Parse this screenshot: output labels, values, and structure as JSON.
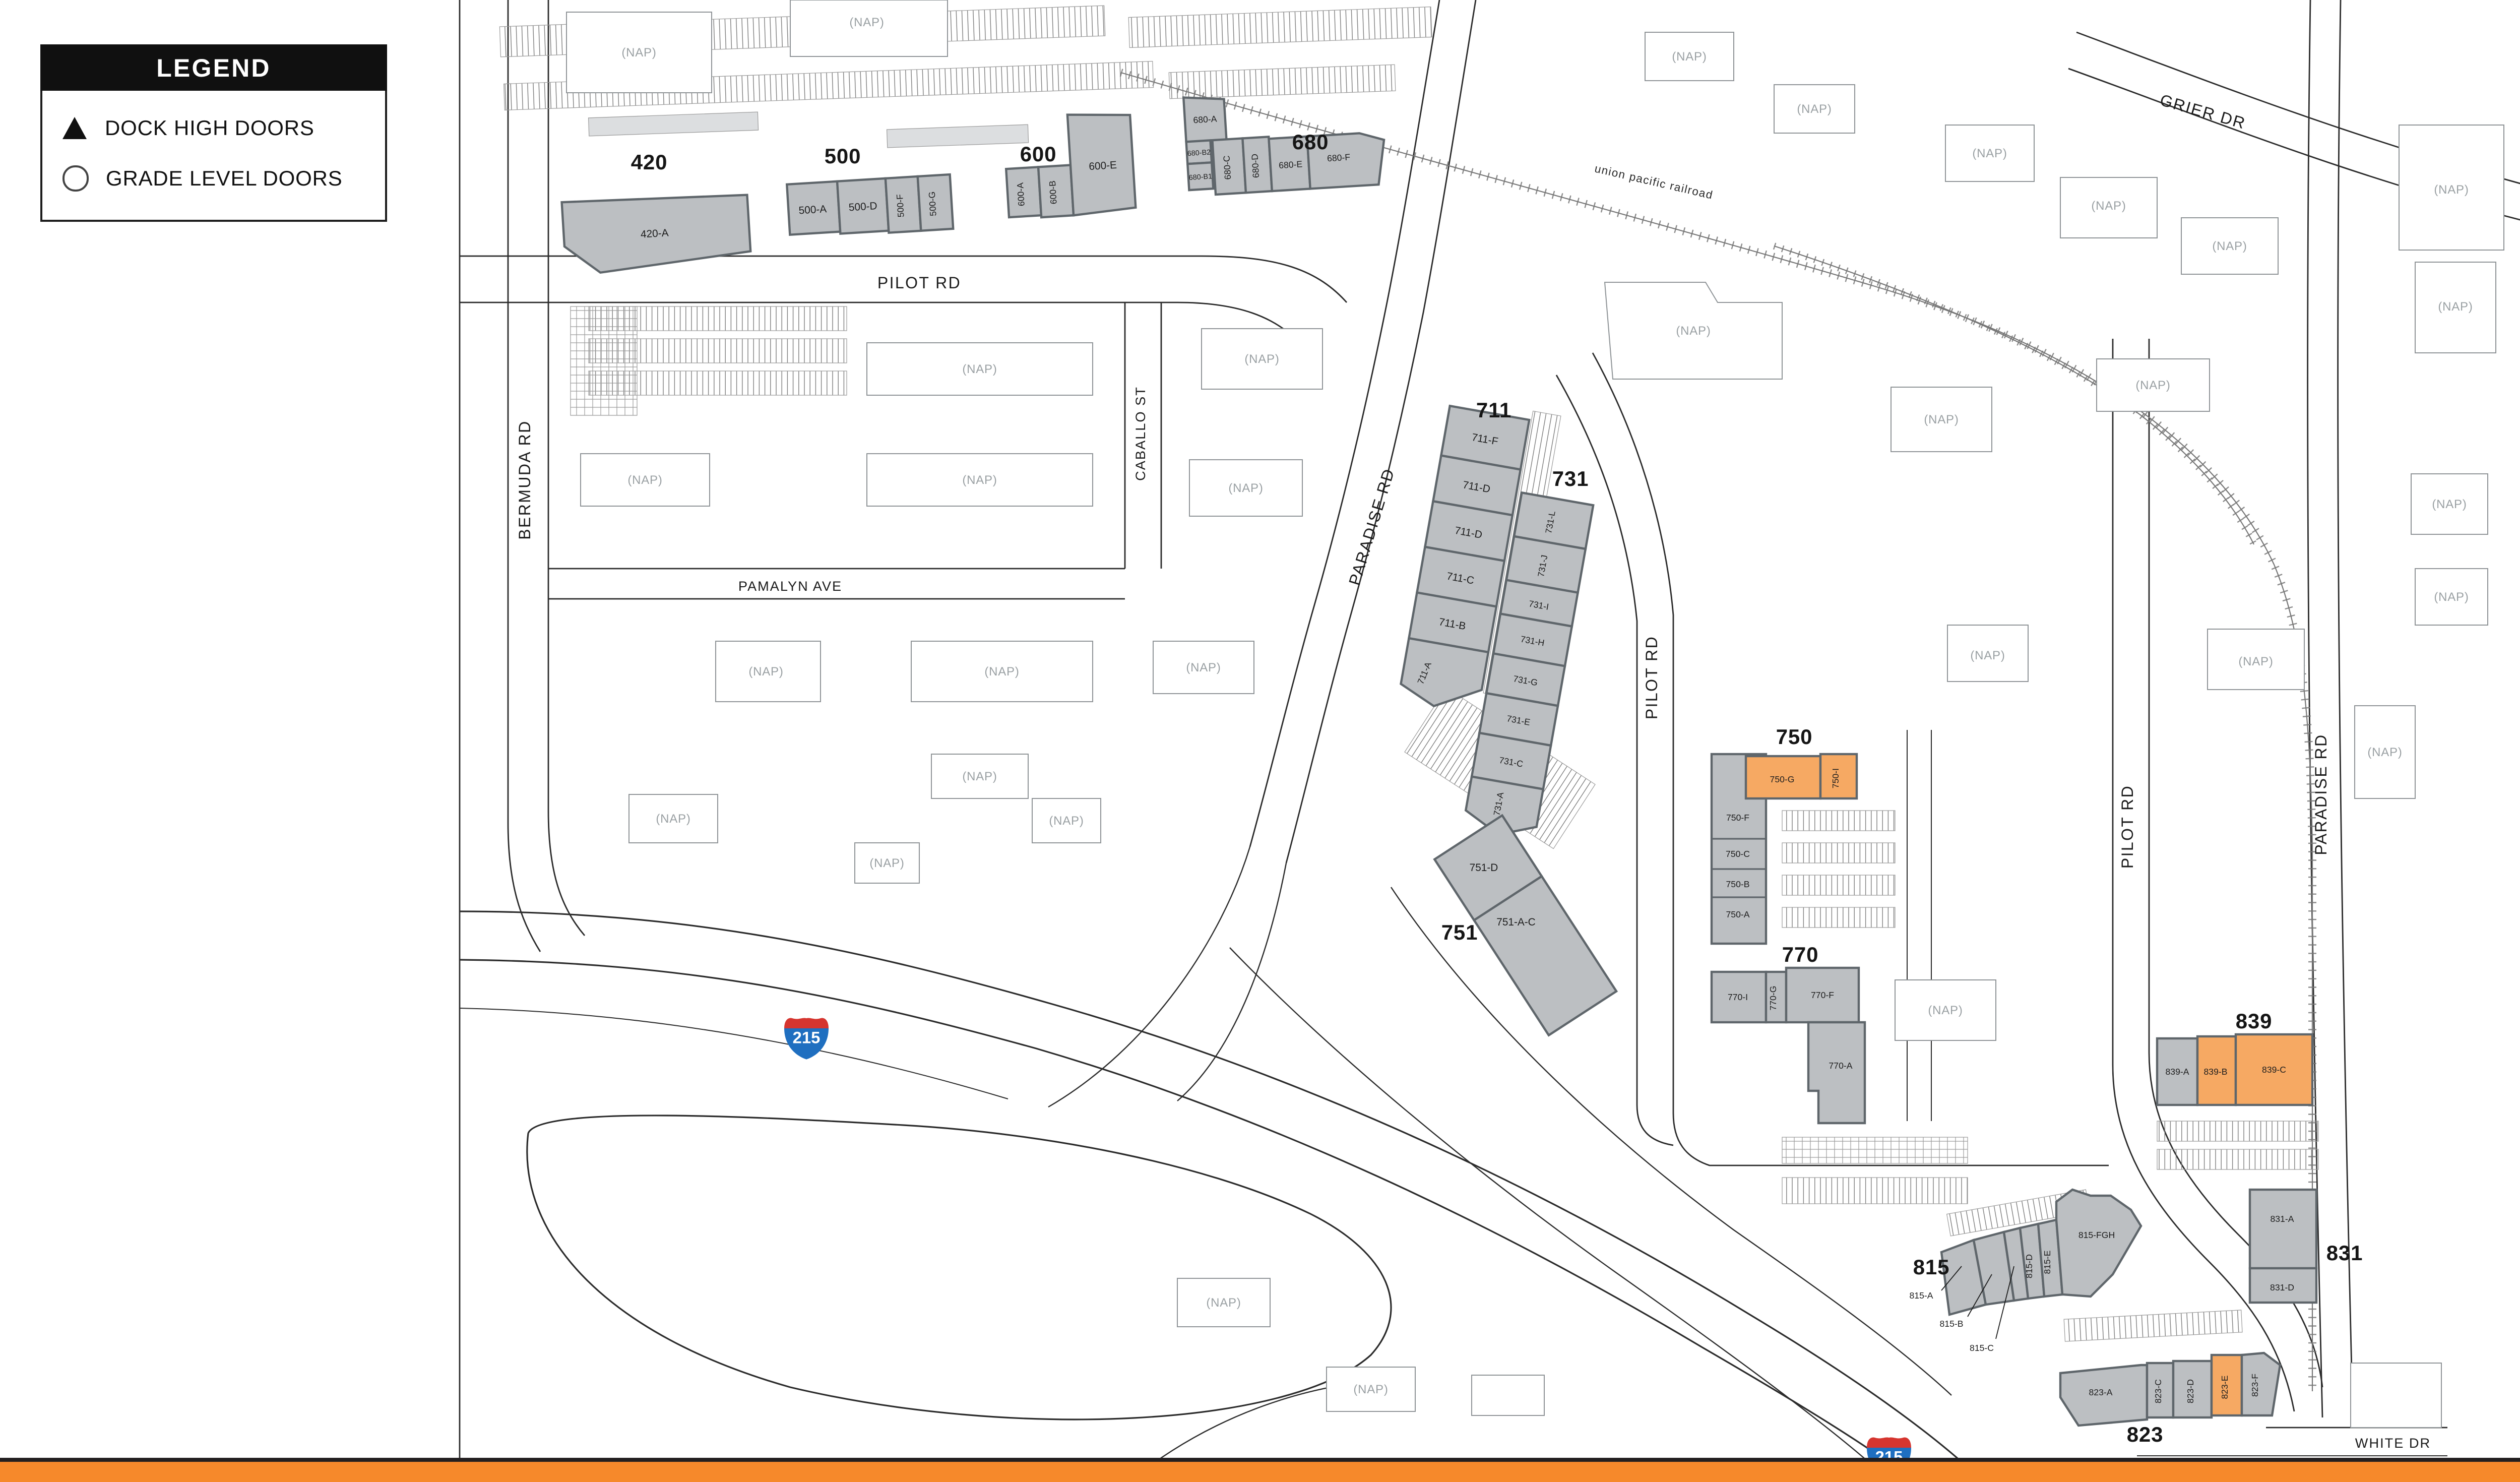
{
  "legend": {
    "title": "LEGEND",
    "items": [
      {
        "symbol": "triangle-icon",
        "label": "DOCK HIGH DOORS"
      },
      {
        "symbol": "circle-icon",
        "label": "GRADE LEVEL DOORS"
      }
    ]
  },
  "compass": {
    "north_label": "N"
  },
  "highway": {
    "interstate_shield": "215"
  },
  "streets": {
    "pilot_rd": "PILOT RD",
    "bermuda_rd": "BERMUDA RD",
    "pamalyn_ave": "PAMALYN AVE",
    "caballo_st": "CABALLO ST",
    "paradise_rd": "PARADISE RD",
    "grier_dr": "GRIER DR",
    "white_dr": "WHITE DR",
    "railroad": "union pacific railroad"
  },
  "labels": {
    "nap": "(NAP)"
  },
  "buildings": {
    "420": {
      "number": "420",
      "units": {
        "a": "420-A"
      }
    },
    "500": {
      "number": "500",
      "units": {
        "a": "500-A",
        "d": "500-D",
        "f": "500-F",
        "g": "500-G"
      }
    },
    "600": {
      "number": "600",
      "units": {
        "a": "600-A",
        "b": "600-B",
        "e": "600-E"
      }
    },
    "680": {
      "number": "680",
      "units": {
        "a": "680-A",
        "b2": "680-B2",
        "b1": "680-B1",
        "c": "680-C",
        "d": "680-D",
        "e": "680-E",
        "f": "680-F"
      }
    },
    "711": {
      "number": "711",
      "units": {
        "f": "711-F",
        "e": "711-E",
        "d": "711-D",
        "c": "711-C",
        "b": "711-B",
        "a": "711-A"
      }
    },
    "731": {
      "number": "731",
      "units": {
        "l": "731-L",
        "j": "731-J",
        "i": "731-I",
        "h": "731-H",
        "g": "731-G",
        "e": "731-E",
        "c": "731-C",
        "a": "731-A"
      }
    },
    "750": {
      "number": "750",
      "units": {
        "g": "750-G",
        "i": "750-I",
        "f": "750-F",
        "c": "750-C",
        "b": "750-B",
        "a": "750-A"
      }
    },
    "751": {
      "number": "751",
      "units": {
        "d": "751-D",
        "ac": "751-A-C"
      }
    },
    "770": {
      "number": "770",
      "units": {
        "i": "770-I",
        "g": "770-G",
        "f": "770-F",
        "a": "770-A"
      }
    },
    "815": {
      "number": "815",
      "units": {
        "a": "815-A",
        "b": "815-B",
        "c": "815-C",
        "d": "815-D",
        "e": "815-E",
        "fgh": "815-FGH"
      }
    },
    "823": {
      "number": "823",
      "units": {
        "a": "823-A",
        "c": "823-C",
        "d": "823-D",
        "e": "823-E",
        "f": "823-F"
      }
    },
    "831": {
      "number": "831",
      "units": {
        "a": "831-A",
        "d": "831-D"
      }
    },
    "839": {
      "number": "839",
      "units": {
        "a": "839-A",
        "b": "839-B",
        "c": "839-C"
      }
    }
  },
  "highlighted_units": [
    "750-G",
    "750-I",
    "839-B",
    "839-C",
    "823-E"
  ],
  "colors": {
    "unit_gray": "#bcbfc2",
    "unit_outline": "#5f666b",
    "unit_highlight": "#f6a963",
    "footer_bar": "#f6892b",
    "road_line": "#2b2b2b",
    "nap_text": "#9aa0a3",
    "shield_red": "#d6352f",
    "shield_blue": "#1f6fc0"
  }
}
